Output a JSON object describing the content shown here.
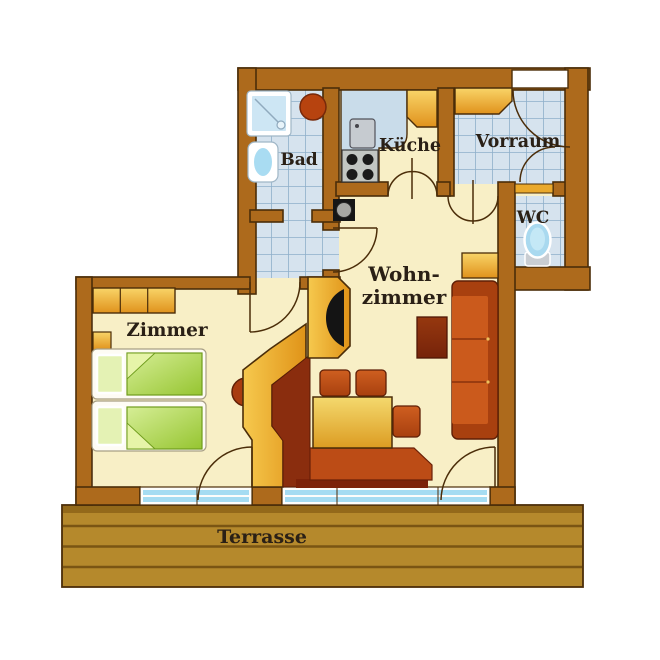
{
  "title": "Apartment floor plan",
  "rooms": {
    "bad": {
      "label": "Bad"
    },
    "kueche": {
      "label": "Küche"
    },
    "vorraum": {
      "label": "Vorraum"
    },
    "wc": {
      "label": "WC"
    },
    "wohnzimmer": {
      "label_line1": "Wohn-",
      "label_line2": "zimmer"
    },
    "zimmer": {
      "label": "Zimmer"
    },
    "terrasse": {
      "label": "Terrasse"
    }
  },
  "fixtures": [
    "shower-tray",
    "washbasin",
    "round-boiler",
    "kitchen-counter",
    "kitchen-sink",
    "stove-four-burners",
    "kitchen-cabinet",
    "hall-wardrobe",
    "toilet",
    "water-heater",
    "bedroom-wardrobe",
    "nightstand",
    "twin-bed-1",
    "twin-bed-2",
    "tiled-stove-knob",
    "chimney-wall",
    "tv-cabinet",
    "tv",
    "corner-bench",
    "dining-table",
    "chair-1",
    "chair-2",
    "chair-3",
    "sofa",
    "side-table",
    "coffee-table"
  ],
  "colors": {
    "wall": "#ad6a1c",
    "wall_outline": "#4b2d09",
    "floor_cream": "#f8efc6",
    "tile_blue": "#d6e3ee",
    "tile_grid": "#8fb0ca",
    "terrace_wood": "#b5892c",
    "window_glass": "#a5dcf2",
    "furniture_orange": "#e8a428",
    "sofa_rust": "#cb5a1c",
    "bench_maroon": "#8a2d0e",
    "duvet_green": "#a6cf44",
    "label_text": "#2a2016"
  }
}
